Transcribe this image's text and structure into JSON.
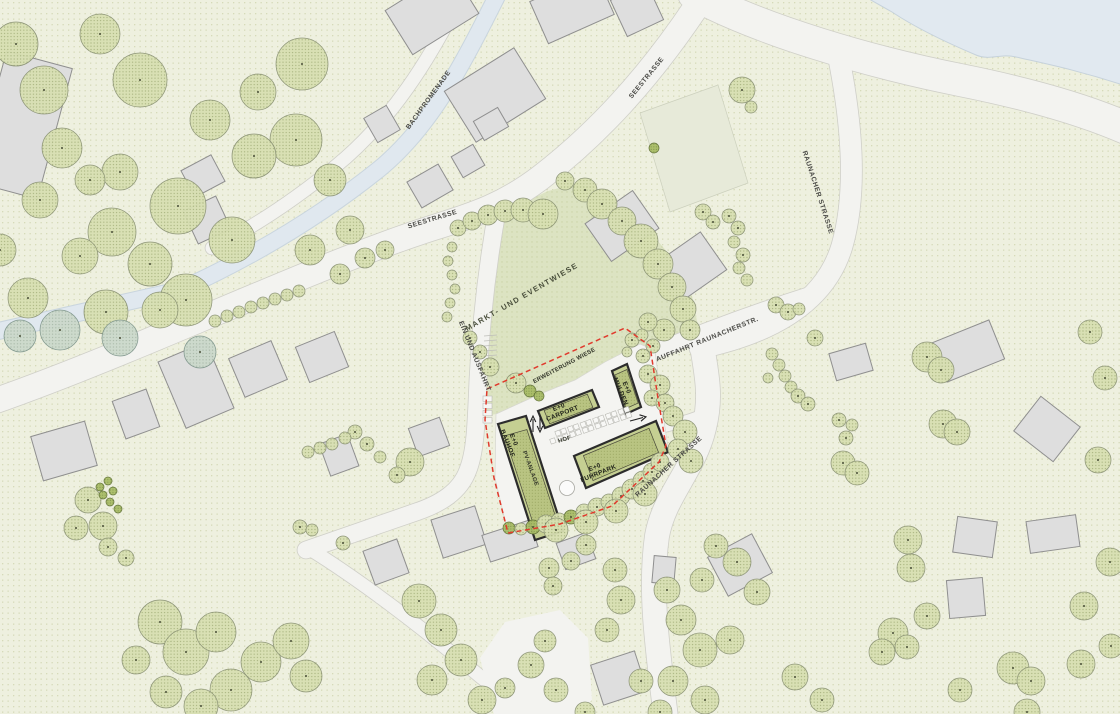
{
  "map": {
    "street_labels": {
      "seestrasse_upper": "SEESTRASSE",
      "seestrasse_top": "SEESTRASSE",
      "bachpromenade": "BACHPROMENADE",
      "raunacher_upper": "RAUNACHER STRASSE",
      "raunacher_lower": "RAUNACHER STRASSE",
      "auffahrt": "AUFFAHRT RAUNACHERSTR.",
      "ein_und_ausfahrt": "EIN UND AUSFAHRT"
    },
    "area_labels": {
      "markt_eventwiese": "MARKT- UND EVENTWIESE",
      "erweiterung_wiese": "ERWEITERUNG WIESE"
    },
    "site_labels": {
      "bauhof_floors": "E+0",
      "bauhof_name": "BAUHOF",
      "carport_floors": "E+0",
      "carport_name": "CARPORT",
      "mulden_floors": "E+0",
      "mulden_name": "MULDEN",
      "fuhrpark_floors": "E+0",
      "fuhrpark_name": "FUHRPARK",
      "pv_anlage": "PV-ANLAGE",
      "hof": "HOF"
    },
    "colors": {
      "background": "#eef0df",
      "background_dot": "#d6dab8",
      "road": "#f3f3f0",
      "road_edge": "#cfcfc8",
      "water": "#e1e9f0",
      "water_edge": "#c6d2db",
      "meadow": "#dce3c2",
      "platform": "#f4f4f1",
      "planned_building": "#c5cf92",
      "planned_building_dark": "#b9c482",
      "planned_outline": "#2c2c2c",
      "existing_building": "#dedede",
      "existing_outline": "#8f8f8f",
      "tree_fill": "#d8e0b2",
      "tree_dot": "#a3af78",
      "tree_edge": "#8a9274",
      "shrub_fill": "#a9bd66",
      "shrub_edge": "#5f7036",
      "teal_tree": "#ccd9cc",
      "site_boundary_red": "#e03a2d",
      "label_text": "#3c3c3c"
    }
  }
}
